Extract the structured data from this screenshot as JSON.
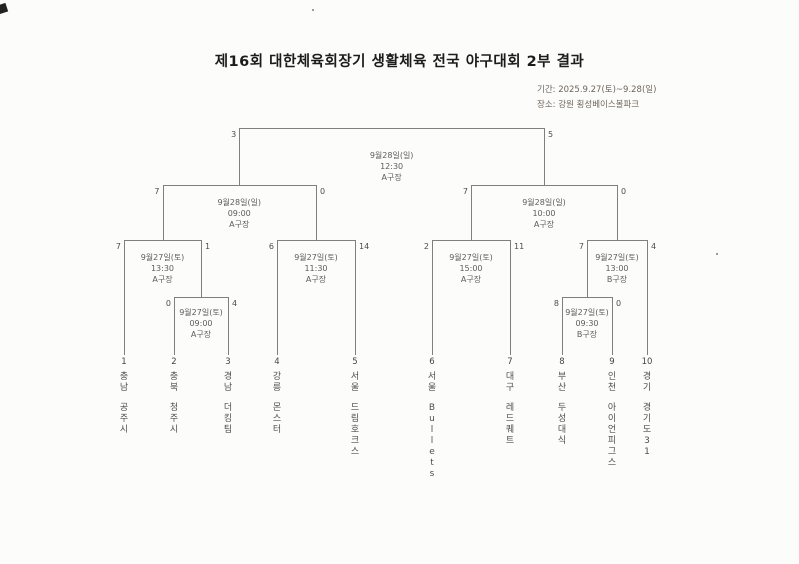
{
  "page": {
    "title": "제16회 대한체육회장기 생활체육 전국 야구대회 2부 결과",
    "period": "기간: 2025.9.27(토)~9.28(일)",
    "location": "장소: 강원 횡성베이스볼파크"
  },
  "bracket": {
    "teams": [
      {
        "no": "1",
        "region": "충남",
        "name": "공주시"
      },
      {
        "no": "2",
        "region": "충북",
        "name": "청주시"
      },
      {
        "no": "3",
        "region": "경남",
        "name": "더킹팀"
      },
      {
        "no": "4",
        "region": "강릉",
        "name": "몬스터"
      },
      {
        "no": "5",
        "region": "서울",
        "name": "드림호크스"
      },
      {
        "no": "6",
        "region": "서울",
        "name": "Bullets"
      },
      {
        "no": "7",
        "region": "대구",
        "name": "레드퀘트"
      },
      {
        "no": "8",
        "region": "부산",
        "name": "두성대식"
      },
      {
        "no": "9",
        "region": "인천",
        "name": "아이언피그스"
      },
      {
        "no": "10",
        "region": "경기",
        "name": "경기도31"
      }
    ],
    "games": {
      "final": {
        "date": "9월28일(일)",
        "time": "12:30",
        "venue": "A구장",
        "left_score": "3",
        "right_score": "5"
      },
      "sf_left": {
        "date": "9월28일(일)",
        "time": "09:00",
        "venue": "A구장",
        "left_score": "7",
        "right_score": "0"
      },
      "sf_right": {
        "date": "9월28일(일)",
        "time": "10:00",
        "venue": "A구장",
        "left_score": "7",
        "right_score": "0"
      },
      "qf_left_outer": {
        "date": "9월27일(토)",
        "time": "13:30",
        "venue": "A구장",
        "left_score": "7",
        "right_score": "1"
      },
      "qf_left_inner": {
        "date": "9월27일(토)",
        "time": "11:30",
        "venue": "A구장",
        "left_score": "6",
        "right_score": "14"
      },
      "qf_right_inner": {
        "date": "9월27일(토)",
        "time": "15:00",
        "venue": "A구장",
        "left_score": "2",
        "right_score": "11"
      },
      "qf_right_outer": {
        "date": "9월27일(토)",
        "time": "13:00",
        "venue": "B구장",
        "left_score": "7",
        "right_score": "4"
      },
      "r1_left": {
        "date": "9월27일(토)",
        "time": "09:00",
        "venue": "A구장",
        "left_score": "0",
        "right_score": "4"
      },
      "r1_right": {
        "date": "9월27일(토)",
        "time": "09:30",
        "venue": "B구장",
        "left_score": "8",
        "right_score": "0"
      }
    }
  }
}
